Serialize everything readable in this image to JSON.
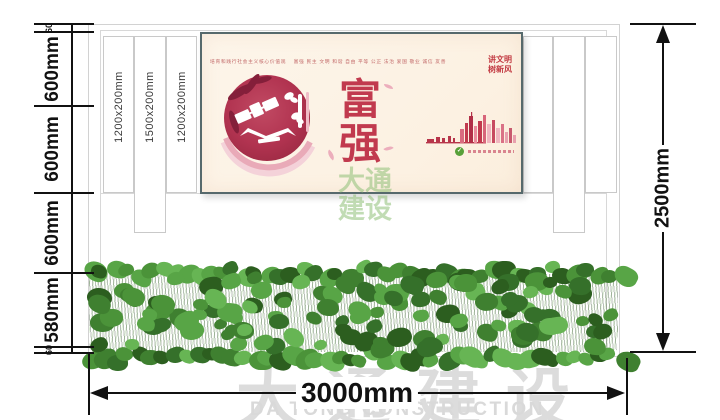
{
  "drawing": {
    "dimensions": {
      "left_chain": [
        "60",
        "600mm",
        "600mm",
        "600mm",
        "580mm",
        "60"
      ],
      "height_total": "2500mm",
      "width_total": "3000mm"
    },
    "pillar_labels": [
      "1200x200mm",
      "1500x200mm",
      "1200x200mm"
    ]
  },
  "poster": {
    "core_values_caption": "培育和践行社会主义核心价值观　 富强 民主 文明 和谐 自由 平等 公正 法治 爱国 敬业 诚信 友善",
    "slogan_line1": "讲文明",
    "slogan_line2": "树新风",
    "char_top": "富",
    "char_bottom": "强"
  },
  "watermark": {
    "center_line1": "大通",
    "center_line2": "建设",
    "bottom_cn": "大通建设",
    "bottom_en": "DA TONG CONSTRUCTION"
  },
  "colors": {
    "poster_red": "#c13a4e",
    "poster_bg": "#fcf2e4",
    "poster_frame": "#56696c",
    "hedge_green": "#3a7a2c",
    "dimension_black": "#111111",
    "watermark_gray": "#d6d6d6",
    "watermark_green": "#8ec076"
  }
}
